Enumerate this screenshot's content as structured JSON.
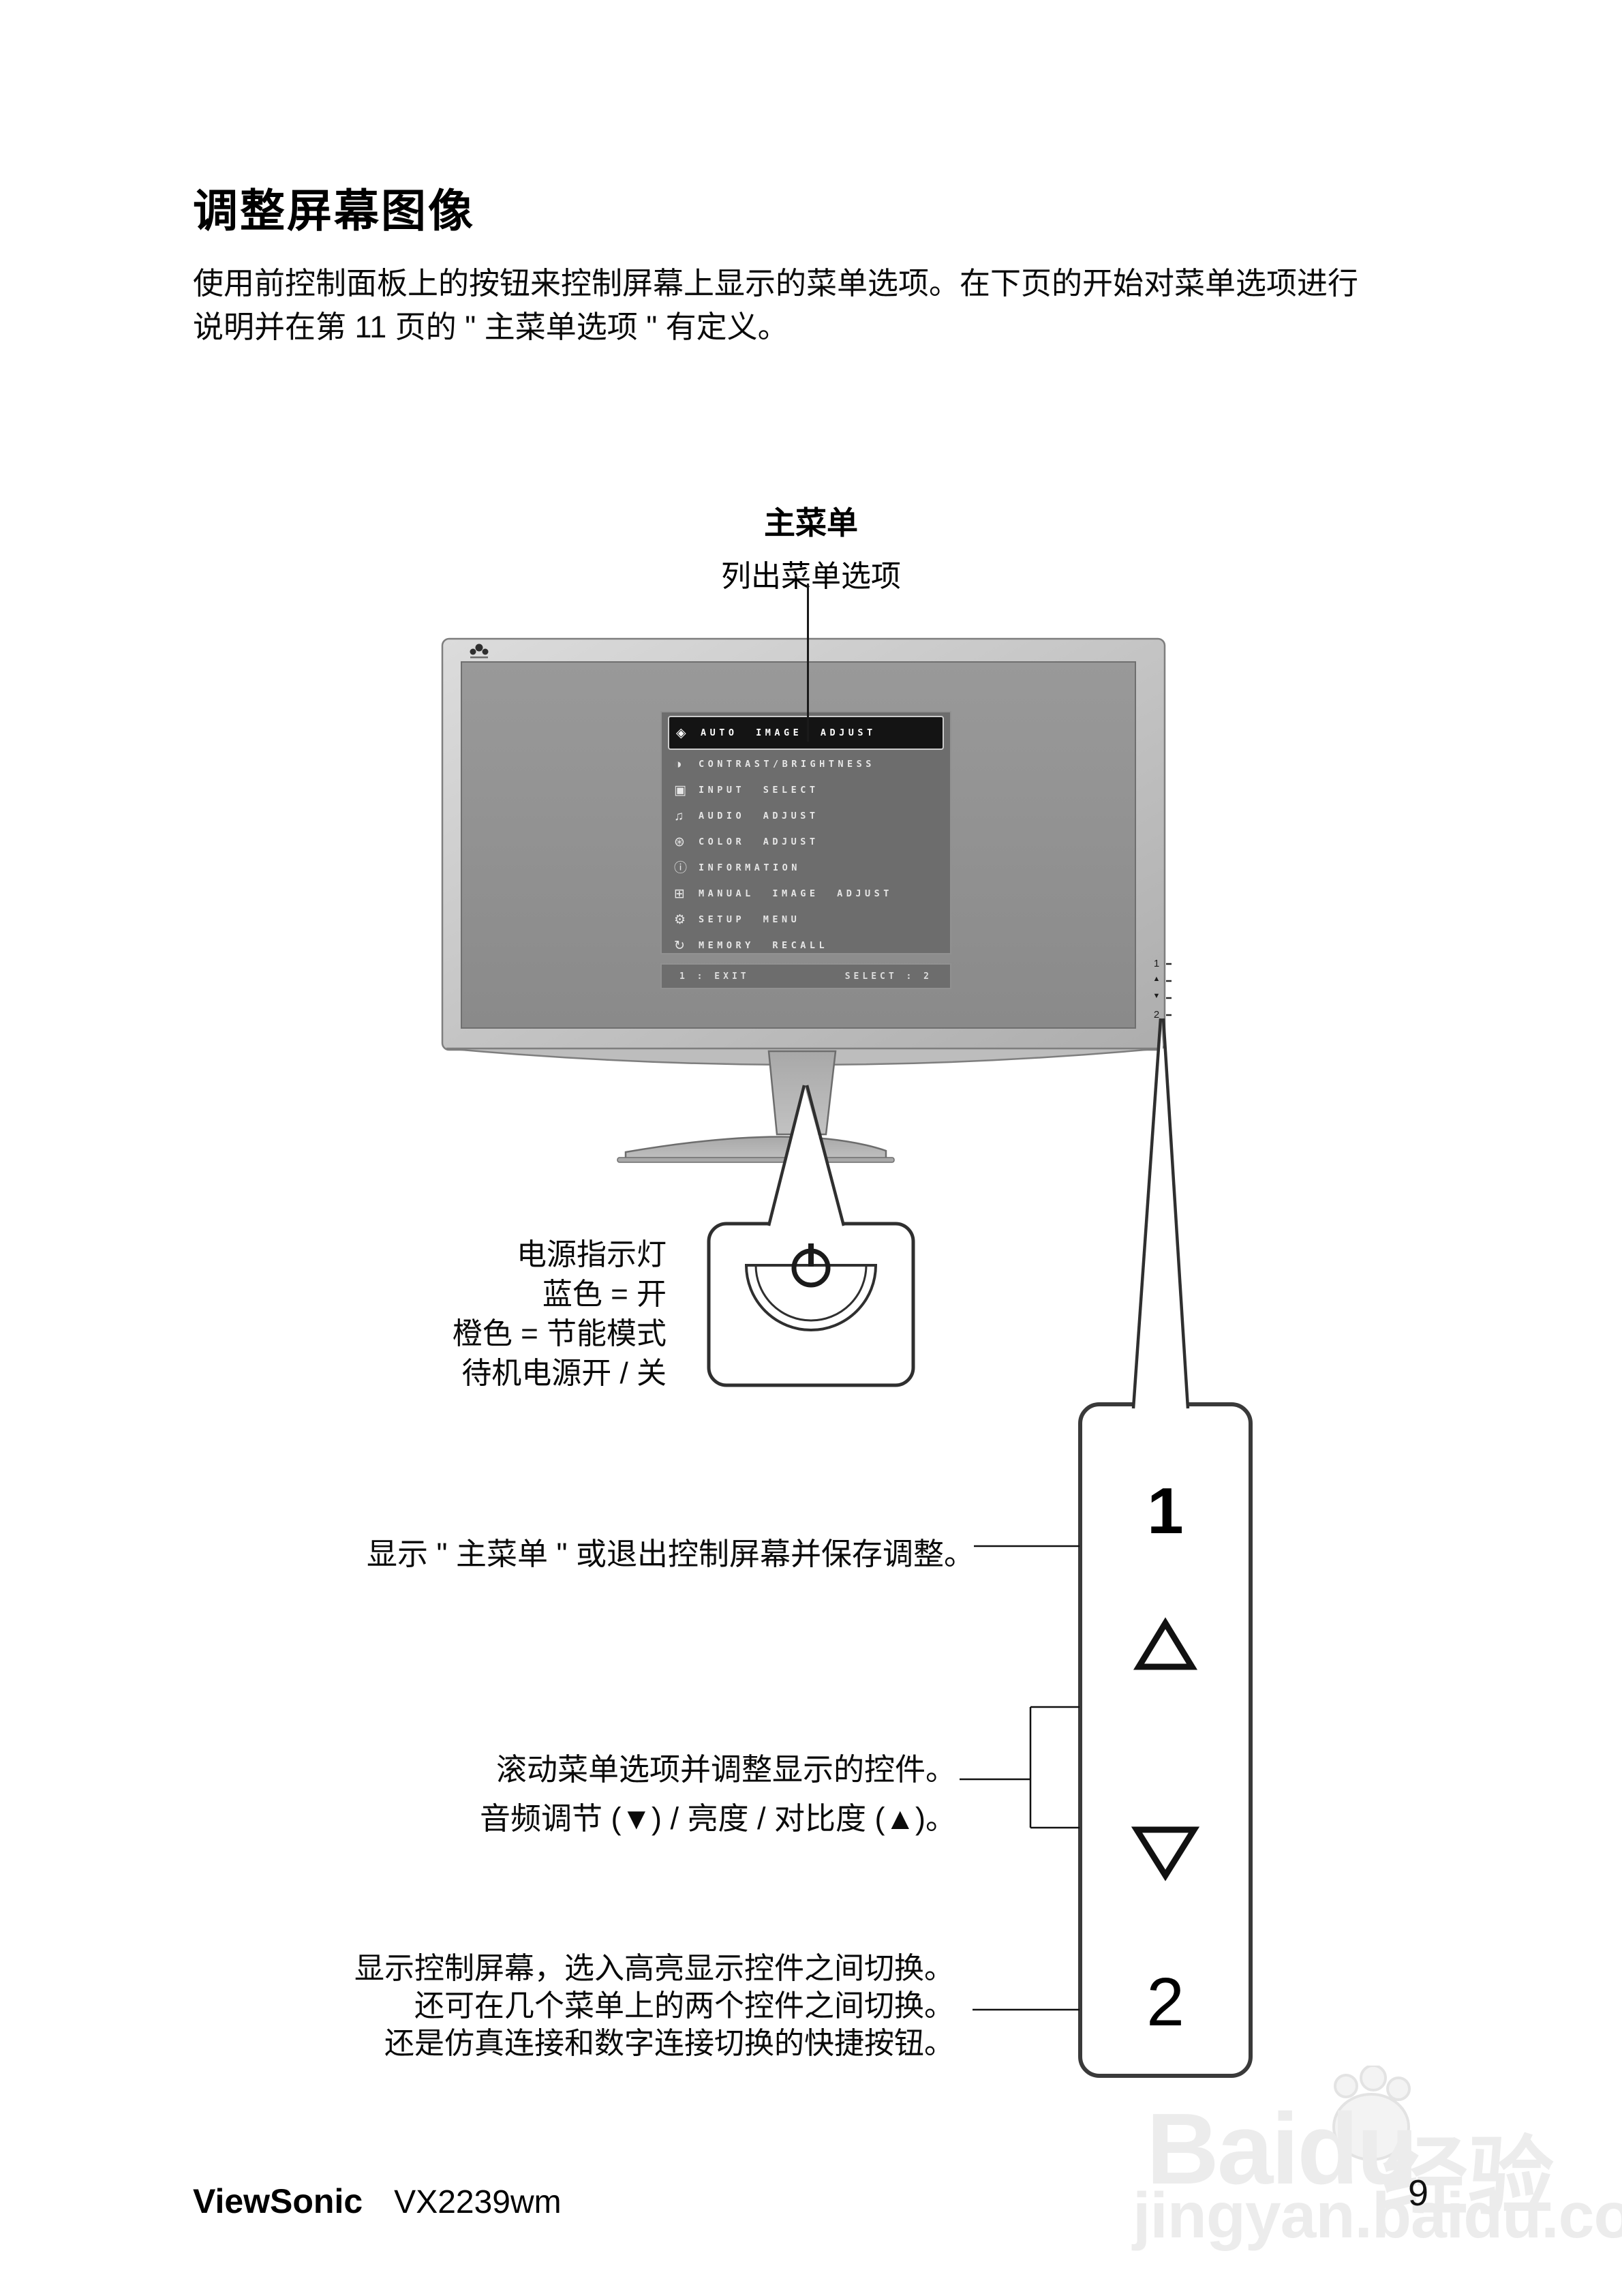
{
  "page": {
    "title": "调整屏幕图像",
    "intro": {
      "line1": "使用前控制面板上的按钮来控制屏幕上显示的菜单选项。在下页的开始对菜单选项进行",
      "line2": "说明并在第 11 页的 \" 主菜单选项 \" 有定义。"
    },
    "footer": {
      "brand": "ViewSonic",
      "model": "VX2239wm",
      "page_number": "9"
    }
  },
  "diagram": {
    "main_menu": {
      "label": "主菜单",
      "sublabel": "列出菜单选项"
    },
    "osd": {
      "items": [
        {
          "icon_name": "auto-image-adjust-icon",
          "icon": "◈",
          "label": "AUTO IMAGE ADJUST"
        },
        {
          "icon_name": "contrast-brightness-icon",
          "icon": "◑",
          "label": "CONTRAST/BRIGHTNESS"
        },
        {
          "icon_name": "input-select-icon",
          "icon": "▣",
          "label": "INPUT SELECT"
        },
        {
          "icon_name": "audio-adjust-icon",
          "icon": "♫",
          "label": "AUDIO ADJUST"
        },
        {
          "icon_name": "color-adjust-icon",
          "icon": "⊛",
          "label": "COLOR ADJUST"
        },
        {
          "icon_name": "information-icon",
          "icon": "ⓘ",
          "label": "INFORMATION"
        },
        {
          "icon_name": "manual-image-adjust-icon",
          "icon": "⊞",
          "label": "MANUAL IMAGE ADJUST"
        },
        {
          "icon_name": "setup-menu-icon",
          "icon": "⚙",
          "label": "SETUP MENU"
        },
        {
          "icon_name": "memory-recall-icon",
          "icon": "↻",
          "label": "MEMORY RECALL"
        }
      ],
      "footer_left": "1 : EXIT",
      "footer_right": "SELECT : 2"
    },
    "bezel_buttons": [
      "1",
      "▲",
      "▼",
      "2"
    ],
    "power_note": {
      "line1": "电源指示灯",
      "line2": "蓝色 = 开",
      "line3": "橙色 = 节能模式",
      "line4": "待机电源开 / 关"
    },
    "callouts": {
      "menu_button": "显示 \" 主菜单 \" 或退出控制屏幕并保存调整。",
      "scroll_line1": "滚动菜单选项并调整显示的控件。",
      "scroll_line2": "音频调节 (▼) / 亮度 / 对比度 (▲)。",
      "hotkey_line1": "显示控制屏幕，选入高亮显示控件之间切换。",
      "hotkey_line2": "还可在几个菜单上的两个控件之间切换。",
      "hotkey_line3": "还是仿真连接和数字连接切换的快捷按钮。"
    },
    "panel": {
      "button_top": "1",
      "button_bottom": "2"
    }
  },
  "watermark": {
    "brand": "Baidu",
    "brand_suffix": "经验",
    "url": "jingyan.baidu.com"
  },
  "colors": {
    "bezel": "#c6c6c6",
    "screen": "#909090",
    "osd_bg": "#6d6d6d",
    "osd_highlight": "#141414",
    "line": "#1a1a1a",
    "watermark": "#ececec"
  }
}
